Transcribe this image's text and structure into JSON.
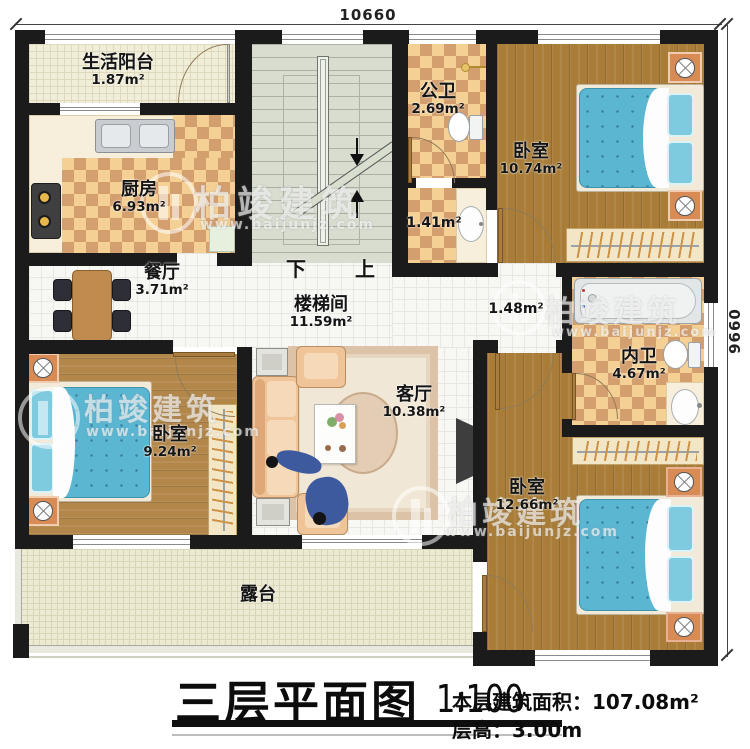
{
  "dimensions": {
    "width": "10660",
    "height": "9660"
  },
  "rooms": {
    "balcony": {
      "name": "生活阳台",
      "area": "1.87m²"
    },
    "kitchen": {
      "name": "厨房",
      "area": "6.93m²"
    },
    "dining": {
      "name": "餐厅",
      "area": "3.71m²"
    },
    "stairwell": {
      "name": "楼梯间",
      "area": "11.59m²"
    },
    "public_bath": {
      "name": "公卫",
      "area": "2.69m²"
    },
    "wash_area": {
      "area": "1.41m²"
    },
    "bedroom_ne": {
      "name": "卧室",
      "area": "10.74m²"
    },
    "hallway": {
      "area": "1.48m²"
    },
    "living": {
      "name": "客厅",
      "area": "10.38m²"
    },
    "inner_bath": {
      "name": "内卫",
      "area": "4.67m²"
    },
    "bedroom_w": {
      "name": "卧室",
      "area": "9.24m²"
    },
    "bedroom_se": {
      "name": "卧室",
      "area": "12.66m²"
    },
    "terrace": {
      "name": "露台"
    }
  },
  "stair": {
    "down": "下",
    "up": "上"
  },
  "title_block": {
    "title": "三层平面图",
    "scale": "1:100",
    "area_line": "本层建筑面积：107.08m²",
    "height_line": "层高：3.00m"
  },
  "watermark": {
    "brand": "柏竣建筑",
    "site": "www.baijunjz.com"
  }
}
